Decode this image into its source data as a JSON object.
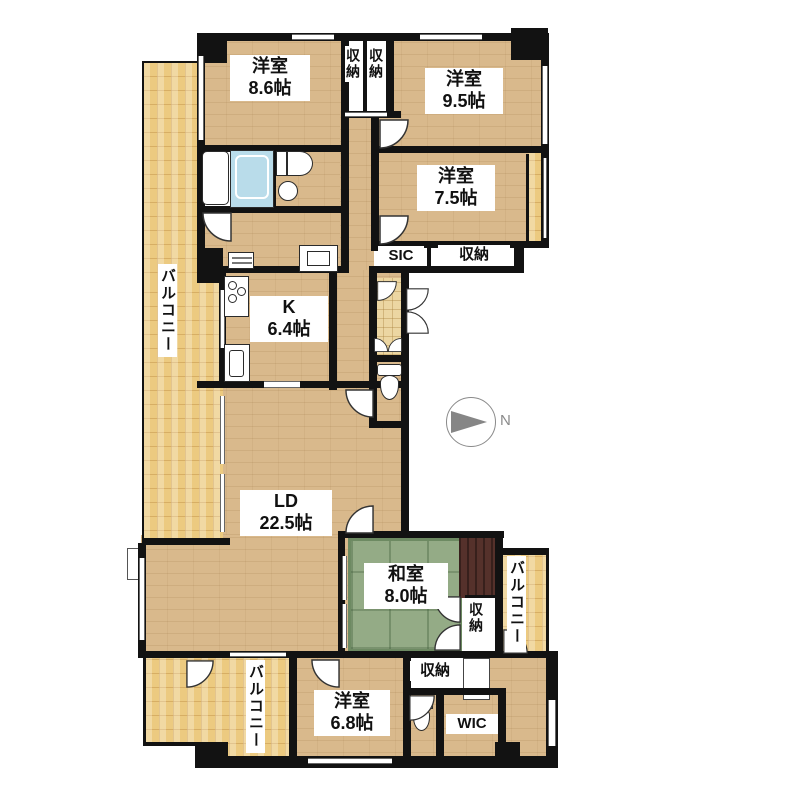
{
  "compass": {
    "north_label": "N"
  },
  "rooms": {
    "bedroom_8_6": {
      "name": "洋室",
      "size": "8.6帖"
    },
    "bedroom_9_5": {
      "name": "洋室",
      "size": "9.5帖"
    },
    "bedroom_7_5": {
      "name": "洋室",
      "size": "7.5帖"
    },
    "bedroom_6_8": {
      "name": "洋室",
      "size": "6.8帖"
    },
    "japanese_room": {
      "name": "和室",
      "size": "8.0帖"
    },
    "living_dining": {
      "name": "LD",
      "size": "22.5帖"
    },
    "kitchen": {
      "name": "K",
      "size": "6.4帖"
    },
    "shoe_in_closet": {
      "label": "SIC"
    },
    "walk_in_closet": {
      "label": "WIC"
    },
    "storage": {
      "label": "収納"
    },
    "balcony": {
      "label": "バルコニー"
    }
  },
  "colors": {
    "wall": "#121212",
    "wood_floor": "#d9b98c",
    "balcony_floor": "#ecca80",
    "tatami": "#94ab86",
    "alcove": "#55312b",
    "bathtub": "#b9dcea",
    "compass_gray": "#868686",
    "background": "#ffffff"
  }
}
